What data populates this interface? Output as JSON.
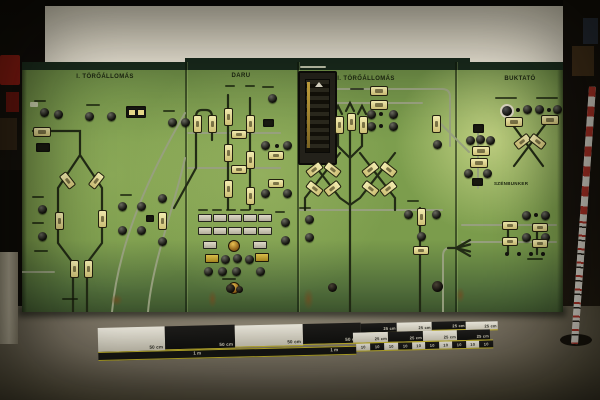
{
  "photo": {
    "panel_titles": [
      "I. TÖRŐÁLLOMÁS",
      "DARU",
      "II. TÖRŐÁLLOMÁS",
      "BUKTATÓ"
    ],
    "panel4_sublabel": "SZÉNBUNKER",
    "scale": {
      "fifty": [
        "50 cm",
        "50 cm",
        "50 cm",
        "50 cm"
      ],
      "twentyfive_top": [
        "25 cm",
        "25 cm",
        "25 cm",
        "25 cm"
      ],
      "twentyfive_bottom": [
        "25 cm",
        "25 cm",
        "25 cm",
        "25 cm"
      ],
      "one_m": [
        "1 m",
        "1 m"
      ],
      "ten": [
        "10",
        "10",
        "10",
        "10",
        "10",
        "10",
        "10",
        "10",
        "10",
        "10"
      ]
    },
    "colors": {
      "panel_green": "#7d9e4e",
      "panel_dark_edge": "#1b2d1e",
      "lamp_cream": "#e9e2a0",
      "scale_yellow": "#cdbd2e",
      "wall_cream": "#f1ebdb",
      "floor_grey": "#7d7565",
      "rod_red": "#bb352a"
    }
  }
}
